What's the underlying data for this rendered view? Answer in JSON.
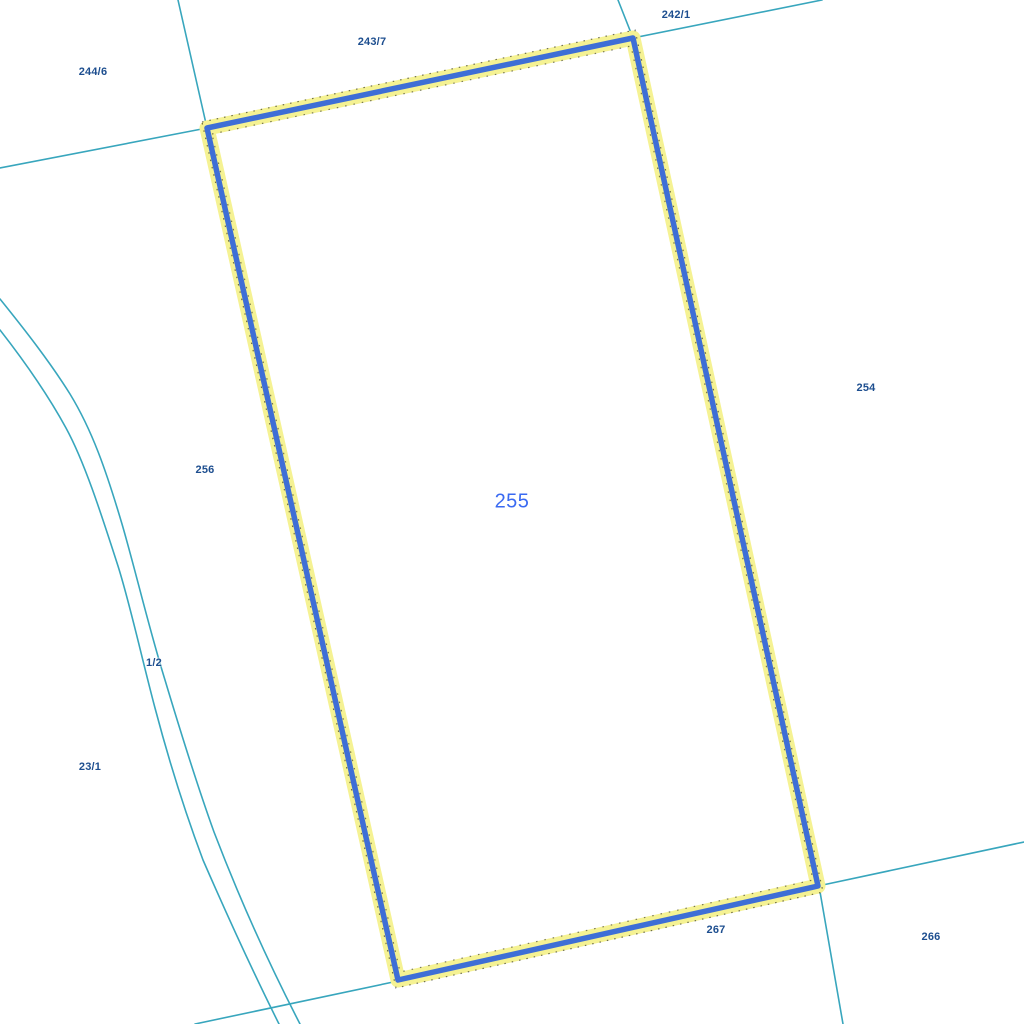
{
  "map": {
    "background_color": "#ffffff",
    "boundary_color": "#38a6bd",
    "label_color": "#1d4e8f",
    "selected_parcel": {
      "id": "255",
      "label_color": "#3a6af2",
      "outline_color": "#3e6ed6",
      "halo_color": "#f5f293",
      "edge_dot_color": "#000000"
    },
    "labels": [
      {
        "text": "244/6",
        "x": 93,
        "y": 72
      },
      {
        "text": "243/7",
        "x": 372,
        "y": 42
      },
      {
        "text": "242/1",
        "x": 676,
        "y": 15
      },
      {
        "text": "254",
        "x": 866,
        "y": 388
      },
      {
        "text": "256",
        "x": 205,
        "y": 470
      },
      {
        "text": "1/2",
        "x": 154,
        "y": 663
      },
      {
        "text": "23/1",
        "x": 90,
        "y": 767
      },
      {
        "text": "267",
        "x": 716,
        "y": 930
      },
      {
        "text": "266",
        "x": 931,
        "y": 937
      }
    ]
  }
}
